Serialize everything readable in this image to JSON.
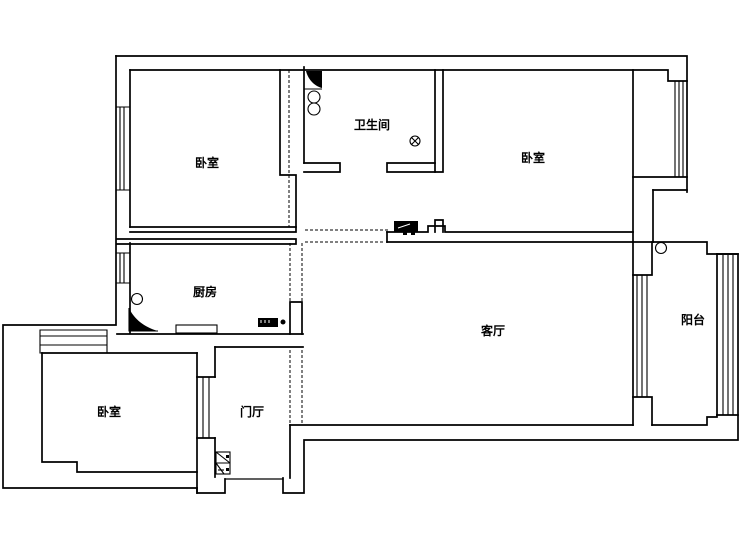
{
  "title": "apartment floor plan",
  "colors": {
    "background": "#ffffff",
    "line": "#000000"
  },
  "rooms": [
    {
      "id": "bedroom-top-left",
      "label": "卧室"
    },
    {
      "id": "bathroom",
      "label": "卫生间"
    },
    {
      "id": "bedroom-top-right",
      "label": "卧室"
    },
    {
      "id": "kitchen",
      "label": "厨房"
    },
    {
      "id": "living-room",
      "label": "客厅"
    },
    {
      "id": "balcony",
      "label": "阳台"
    },
    {
      "id": "bedroom-bottom-left",
      "label": "卧室"
    },
    {
      "id": "foyer",
      "label": "门厅"
    }
  ],
  "fixtures": {
    "bathroom": [
      "corner-shower",
      "basin-circles",
      "floor-drain"
    ],
    "kitchen": [
      "corner-sink",
      "burner-circle",
      "counter",
      "stove-block"
    ],
    "foyer": [
      "entry-door-fixture"
    ],
    "balcony": [
      "corner-circle"
    ],
    "hall": [
      "cabinet-block"
    ]
  }
}
